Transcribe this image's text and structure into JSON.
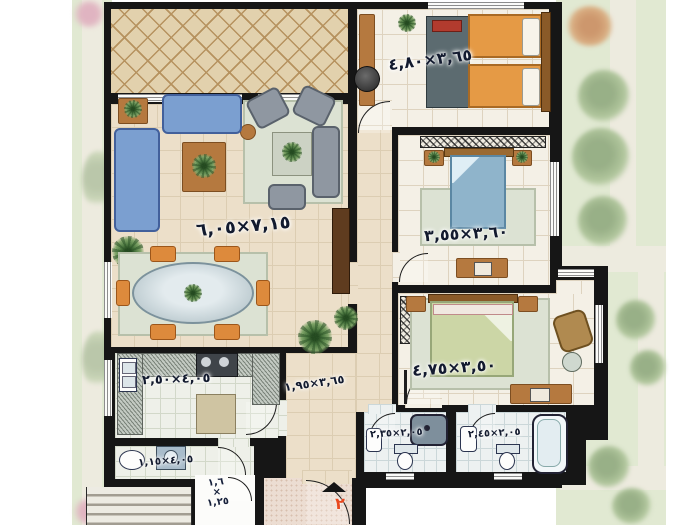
{
  "unit": {
    "number": "٢"
  },
  "rooms": {
    "living": {
      "dim": "٧,١٥×٦,٠٥"
    },
    "bedroom1": {
      "dim": "٣,٦٥×٤,٨٠"
    },
    "bedroom2": {
      "dim": "٣,٦٠×٣,٥٥"
    },
    "master": {
      "dim": "٣,٥٠×٤,٧٥"
    },
    "kitchen": {
      "dim": "٤,٠٥×٢,٥٠"
    },
    "hall": {
      "dim": "٣,٦٥×١,٩٥"
    },
    "wc": {
      "dim": "٤,٠٥×١,١٥"
    },
    "bath1": {
      "dim": "٢,٠٥×٢,٣٥"
    },
    "bath2": {
      "dim": "٢,٠٥×٢,٤٥"
    },
    "shaft": {
      "w": "١,٦",
      "times": "×",
      "h": "١,٢٥"
    }
  },
  "colors": {
    "wall": "#161616",
    "floor": "#ecdfc9",
    "balcony": "#e2d1ad",
    "garden": "#d9e3c6",
    "accent_red": "#e8491f",
    "sofa_blue": "#7b9fd0",
    "bed_orange": "#e59a45",
    "bed_blue": "#8fb4cb",
    "bed_green": "#ccd6a6",
    "wood": "#b5793f"
  }
}
